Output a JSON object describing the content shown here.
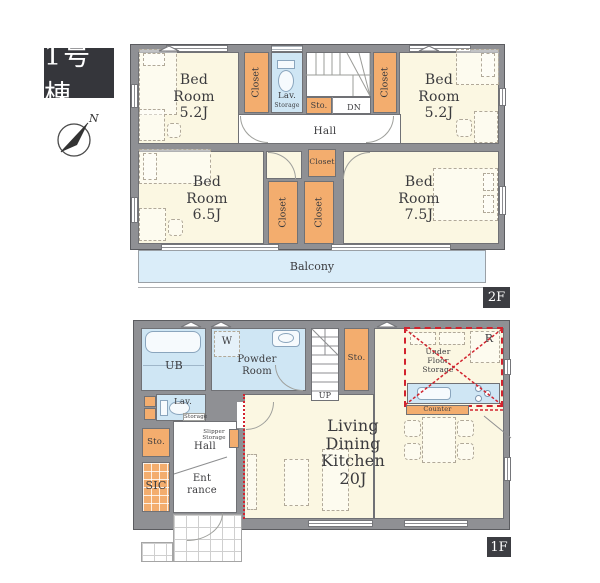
{
  "building": {
    "label": "1号棟"
  },
  "compass": {
    "north_label": "N"
  },
  "floor_2f": {
    "floor_tag": "2F",
    "bedroom_nw": {
      "lines": [
        "Bed",
        "Room",
        "5.2J"
      ]
    },
    "bedroom_ne": {
      "lines": [
        "Bed",
        "Room",
        "5.2J"
      ]
    },
    "bedroom_sw": {
      "lines": [
        "Bed",
        "Room",
        "6.5J"
      ]
    },
    "bedroom_se": {
      "lines": [
        "Bed",
        "Room",
        "7.5J"
      ]
    },
    "closet_label": "Closet",
    "lav_label": "Lav.",
    "lav_storage_label": "Storage",
    "storage_label": "Sto.",
    "stairs_down_label": "DN",
    "hall_label": "Hall",
    "balcony_label": "Balcony"
  },
  "floor_1f": {
    "floor_tag": "1F",
    "bath_label": "UB",
    "washer_label": "W",
    "powder_room": {
      "lines": [
        "Powder",
        "Room"
      ]
    },
    "lav_label": "Lav.",
    "lav_storage_label": "Storage",
    "storage_upper_label": "Sto.",
    "stairs_up_label": "UP",
    "hall_label": "Hall",
    "slipper_storage": {
      "lines": [
        "Slipper",
        "Storage"
      ]
    },
    "storage_lower_label": "Sto.",
    "shoe_closet_label": "SIC",
    "entrance": {
      "lines": [
        "Ent",
        "rance"
      ]
    },
    "under_floor_storage": {
      "lines": [
        "Under",
        "Floor",
        "Storage"
      ]
    },
    "refrigerator_label": "R",
    "counter_label": "Counter",
    "ldk": {
      "lines": [
        "Living",
        "Dining",
        "Kitchen",
        "20J"
      ]
    }
  },
  "colors": {
    "wall_gray": "#8f9094",
    "room_cream": "#fbf7e2",
    "closet_orange": "#f3ad6e",
    "wet_area_blue": "#cfe6f4",
    "balcony_blue": "#daedf9",
    "ldk_boundary_red": "#d2232e",
    "floor_tag_bg": "#3c3d42",
    "building_label_bg": "#35363b"
  }
}
